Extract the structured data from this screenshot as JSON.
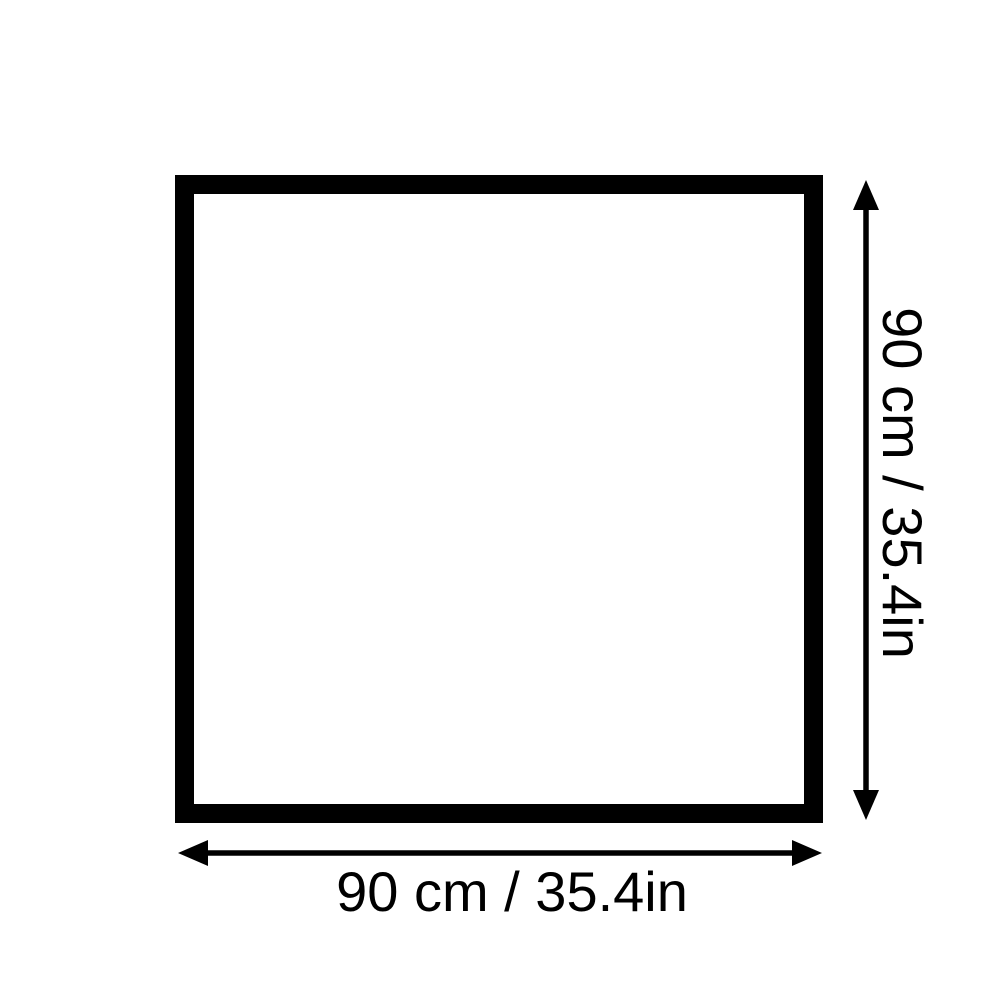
{
  "diagram": {
    "width_label": "90 cm / 35.4in",
    "height_label": "90 cm / 35.4in"
  },
  "colors": {
    "ink": "#000000",
    "background": "#ffffff"
  }
}
